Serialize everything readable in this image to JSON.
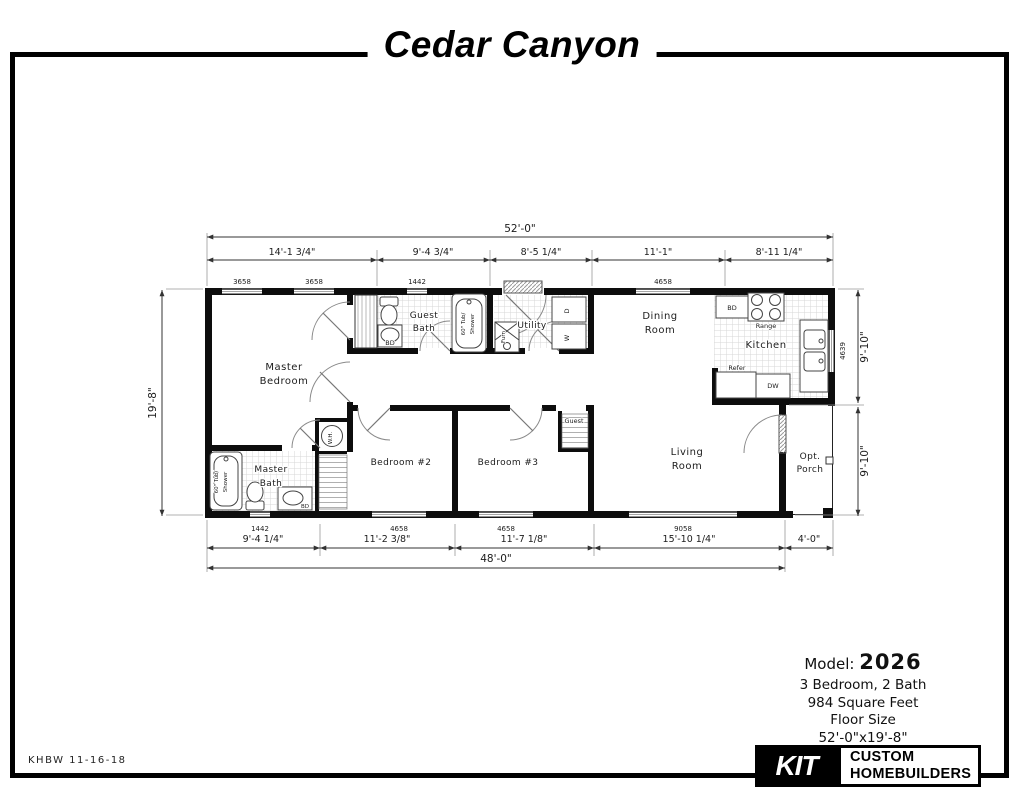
{
  "title": "Cedar Canyon",
  "plate": {
    "code": "KHBW 11-16-18"
  },
  "info": {
    "model_label": "Model:",
    "model_number": "2026",
    "bed_bath": "3 Bedroom, 2 Bath",
    "sqft": "984 Square Feet",
    "floor_size_label": "Floor Size",
    "floor_size": "52'-0\"x19'-8\""
  },
  "logo": {
    "mark": "KIT",
    "name_line1": "CUSTOM",
    "name_line2": "HOMEBUILDERS"
  },
  "dims": {
    "top_overall": "52'-0\"",
    "top_segments": [
      "14'-1 3/4\"",
      "9'-4 3/4\"",
      "8'-5 1/4\"",
      "11'-1\"",
      "8'-11 1/4\""
    ],
    "left_overall": "19'-8\"",
    "right_upper": "9'-10\"",
    "right_lower": "9'-10\"",
    "bottom_segments": [
      "9'-4 1/4\"",
      "11'-2 3/8\"",
      "11'-7 1/8\"",
      "15'-10 1/4\"",
      "4'-0\""
    ],
    "bottom_overall": "48'-0\""
  },
  "windows": {
    "top": [
      "3658",
      "3658",
      "1442",
      "4658"
    ],
    "right": [
      "4639"
    ],
    "bottom": [
      "1442",
      "4658",
      "4658",
      "9058"
    ]
  },
  "rooms": {
    "master_bedroom": [
      "Master",
      "Bedroom"
    ],
    "guest_bath": [
      "Guest",
      "Bath"
    ],
    "utility": [
      "Utility"
    ],
    "dining_room": [
      "Dining",
      "Room"
    ],
    "kitchen": [
      "Kitchen"
    ],
    "living_room": [
      "Living",
      "Room"
    ],
    "opt_porch": [
      "Opt.",
      "Porch"
    ],
    "bedroom_2": [
      "Bedroom #2"
    ],
    "bedroom_3": [
      "Bedroom #3"
    ],
    "master_bath": [
      "Master",
      "Bath"
    ],
    "guest_closet": [
      "Guest"
    ]
  },
  "fixtures": {
    "guest_tub": [
      "60\" Tub/",
      "Shower"
    ],
    "master_tub": [
      "60\" Tub/",
      "Shower"
    ],
    "guest_bath_sink": "BD",
    "master_bath_sink": "BD",
    "kitchen_cabinet": "BD",
    "range": "Range",
    "refrigerator": "Refer",
    "dishwasher": "DW",
    "furnace": "Furn",
    "dryer": "D",
    "washer": "W",
    "water_heater": "W.H."
  }
}
